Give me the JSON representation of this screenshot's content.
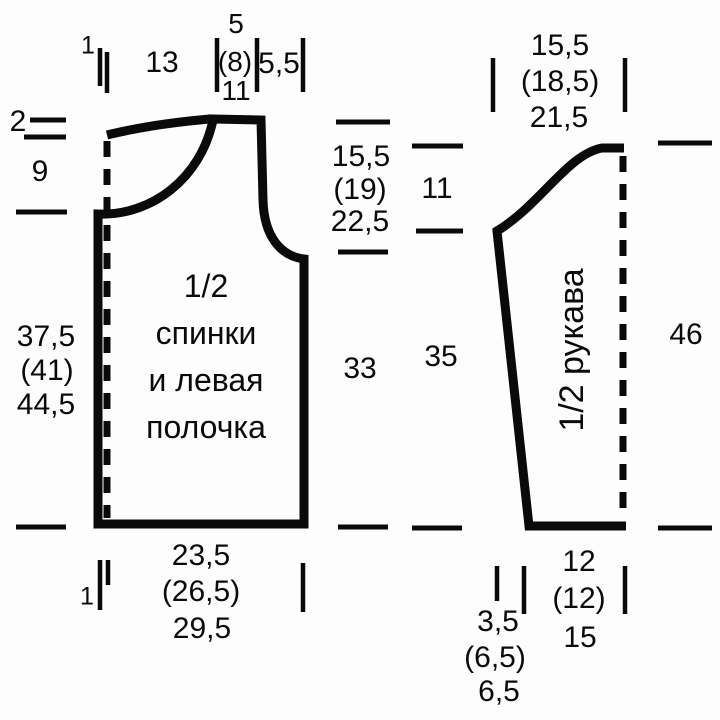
{
  "colors": {
    "background": "#fdfdfd",
    "ink": "#0a0a0a"
  },
  "body": {
    "title": {
      "line1": "1/2",
      "line2": "спинки",
      "line3": "и левая",
      "line4": "полочка"
    },
    "measures": {
      "center_offset_top": "1",
      "back_half_width": "13",
      "shoulder_s1": "5",
      "shoulder_s2": "(8)",
      "shoulder_s3": "11",
      "armhole_top_width": "5,5",
      "back_neck_depth": "2",
      "front_neck_depth": "9",
      "front_length_s1": "37,5",
      "front_length_s2": "(41)",
      "front_length_s3": "44,5",
      "armhole_depth_s1": "15,5",
      "armhole_depth_s2": "(19)",
      "armhole_depth_s3": "22,5",
      "side_seam_length": "33",
      "hem_half_width_s1": "23,5",
      "hem_half_width_s2": "(26,5)",
      "hem_half_width_s3": "29,5",
      "center_offset_bottom": "1"
    }
  },
  "sleeve": {
    "title": "1/2 рукава",
    "measures": {
      "top_half_width_s1": "15,5",
      "top_half_width_s2": "(18,5)",
      "top_half_width_s3": "21,5",
      "cap_height": "11",
      "underarm_seam": "35",
      "total_length": "46",
      "cuff_half_width_s1": "12",
      "cuff_half_width_s2": "(12)",
      "cuff_half_width_s3": "15",
      "cuff_slant_s1": "3,5",
      "cuff_slant_s2": "(6,5)",
      "cuff_slant_s3": "6,5"
    }
  }
}
